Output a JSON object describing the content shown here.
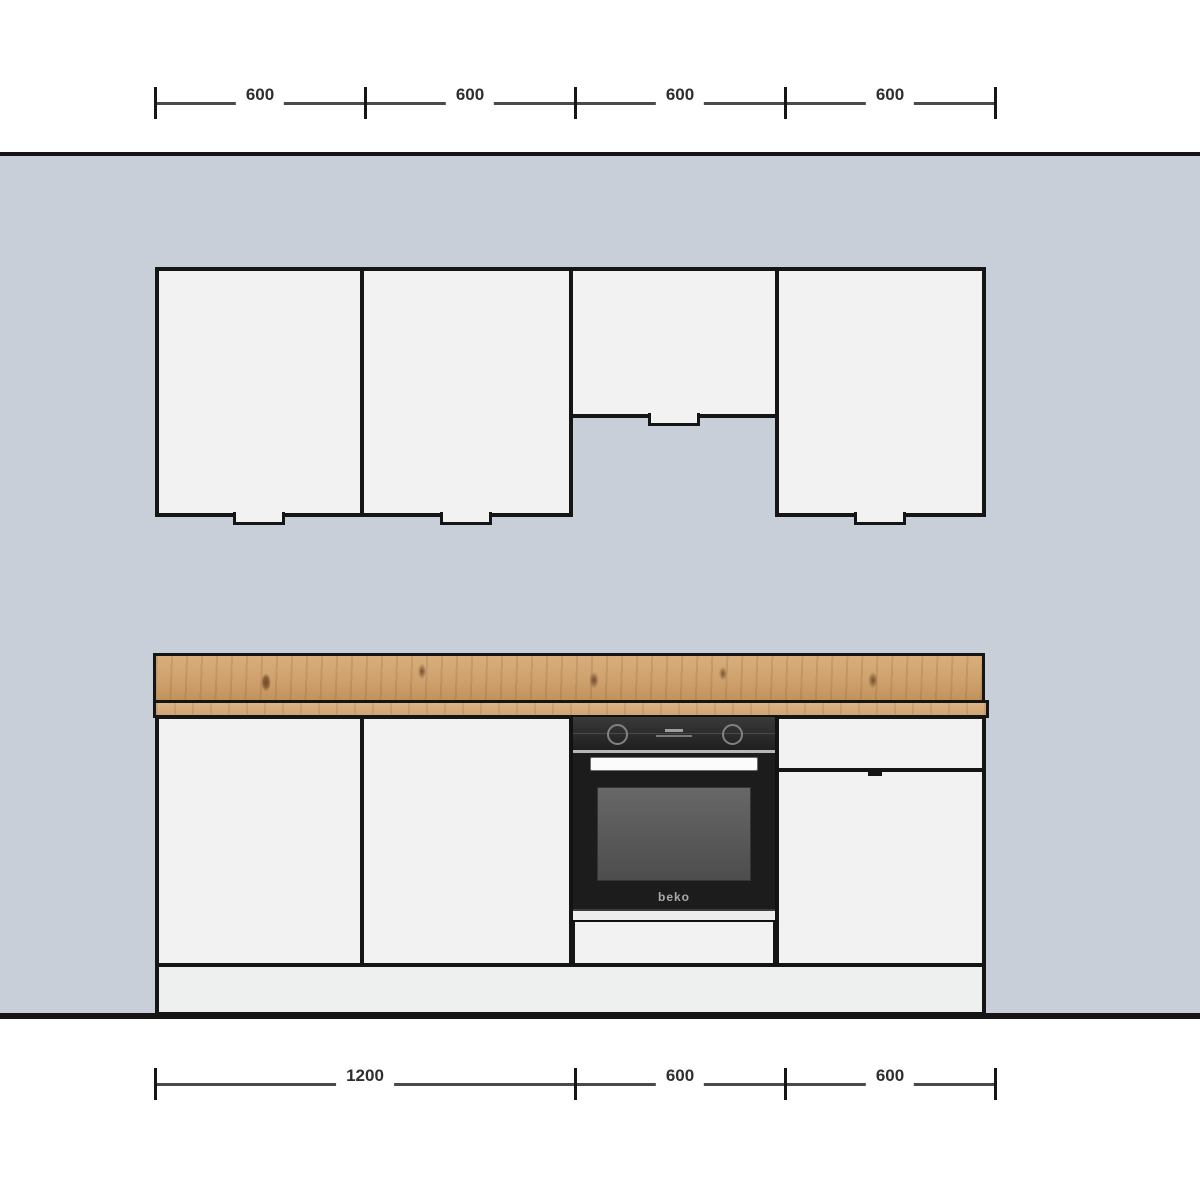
{
  "scene": {
    "type": "kitchen-elevation-drawing",
    "colors": {
      "wall": "#c9cfd9",
      "cabinet_front": "#f2f2f2",
      "outline": "#151515",
      "worktop_wood": "#cfa26d",
      "oven_body": "#1c1c1c"
    },
    "top_dimensions": {
      "labels": [
        "600",
        "600",
        "600",
        "600"
      ]
    },
    "bottom_dimensions": {
      "labels": [
        "1200",
        "600",
        "600"
      ]
    },
    "oven": {
      "brand": "beko"
    }
  }
}
